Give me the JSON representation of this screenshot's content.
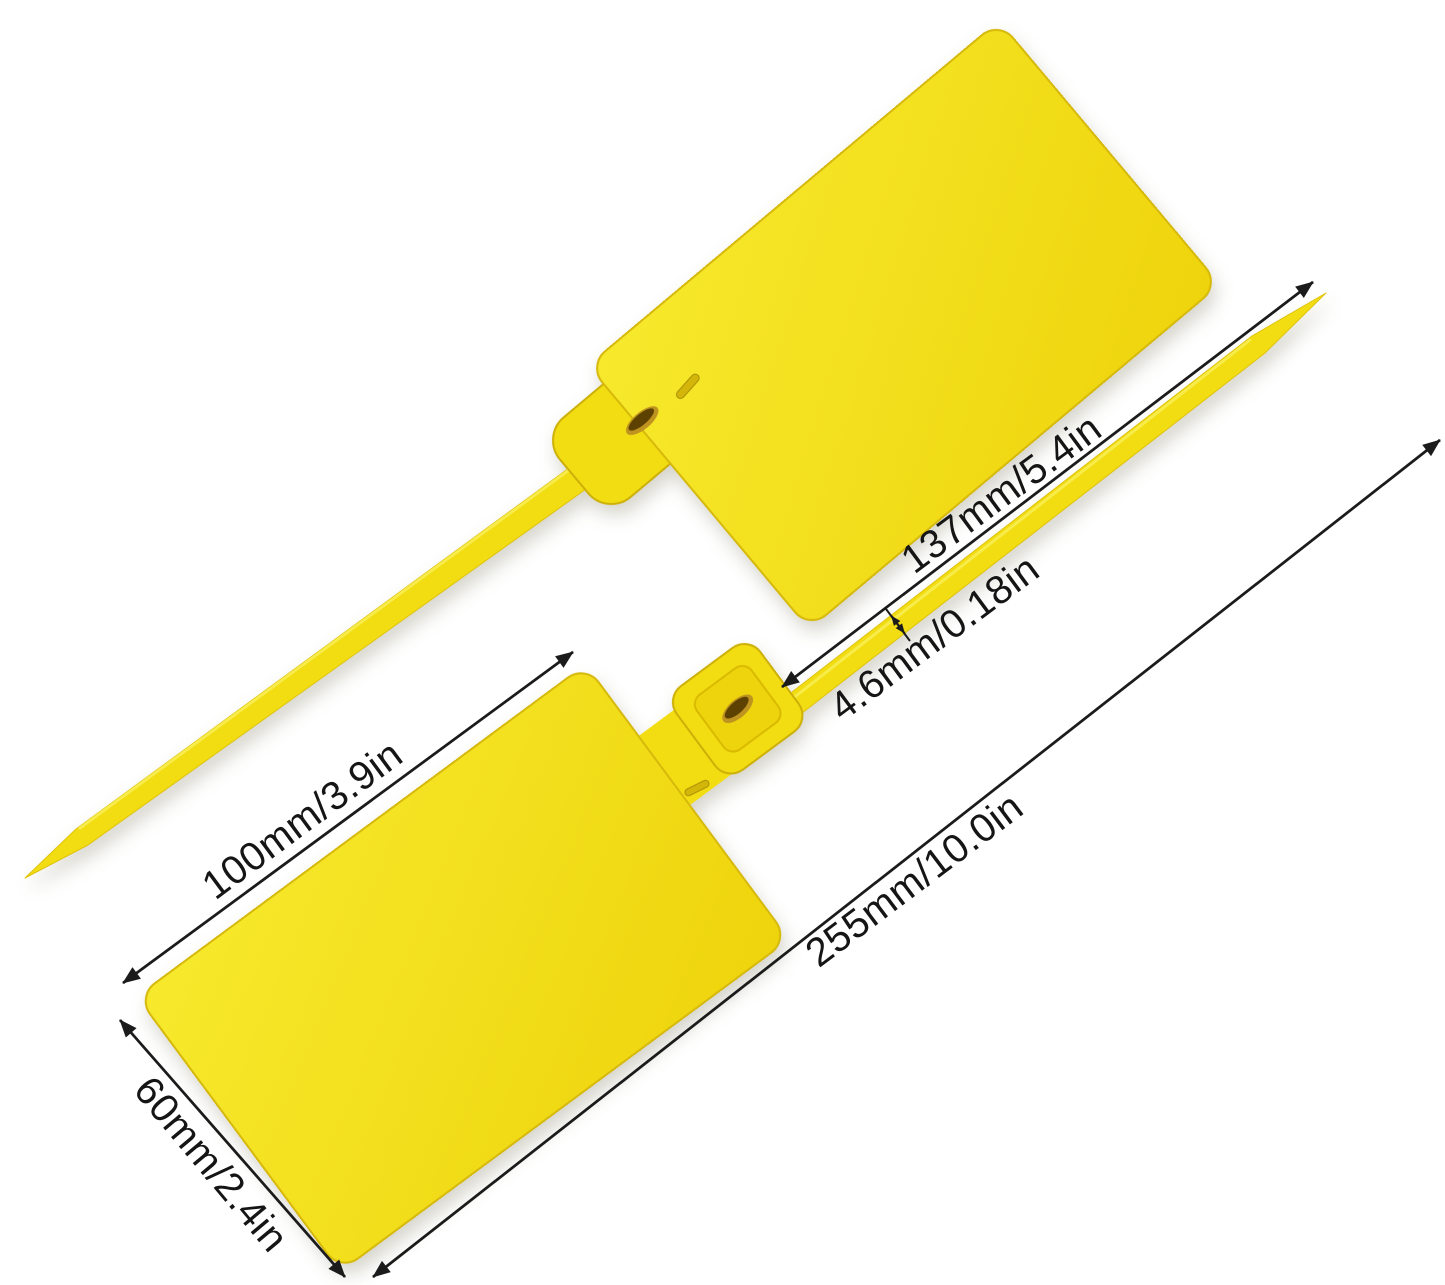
{
  "colors": {
    "background": "#FFFFFF",
    "tag_yellow": "#F2DC12",
    "tag_yellow_light": "#F7E92C",
    "tag_yellow_deep": "#EED40C",
    "tag_edge": "#D6B90A",
    "strap_highlight": "#F9EE55",
    "slot_gold": "#BE9320",
    "slot_dark": "#5C4100",
    "dimension_line": "#1B1B1B",
    "label_text": "#151515"
  },
  "dimensions": {
    "strap_length": "137mm/5.4in",
    "strap_width": "4.6mm/0.18in",
    "plate_length": "100mm/3.9in",
    "total_length": "255mm/10.0in",
    "plate_width": "60mm/2.4in"
  }
}
